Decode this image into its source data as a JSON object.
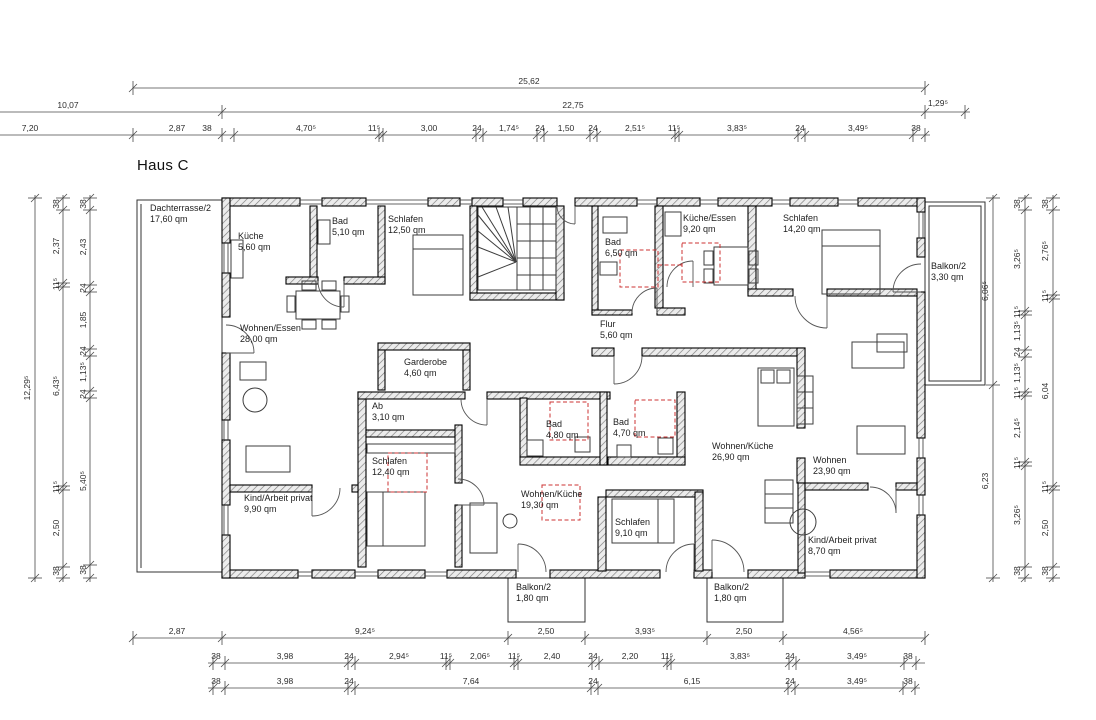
{
  "title": "Haus C",
  "colors": {
    "marker_red": "#cc3333",
    "wall_hatch": "#7a7a7a",
    "line": "#000000"
  },
  "drawing": {
    "labels": [
      {
        "t": "25,62",
        "x": 529,
        "y": 86,
        "c": "dim"
      },
      {
        "t": "10,07",
        "x": 68,
        "y": 110,
        "c": "dim"
      },
      {
        "t": "22,75",
        "x": 573,
        "y": 110,
        "c": "dim"
      },
      {
        "t": "1,29⁵",
        "x": 938,
        "y": 108,
        "c": "dim"
      },
      {
        "t": "7,20",
        "x": 30,
        "y": 133,
        "c": "dim"
      },
      {
        "t": "2,87",
        "x": 177,
        "y": 133,
        "c": "dim"
      },
      {
        "t": "38",
        "x": 207,
        "y": 133,
        "c": "dim"
      },
      {
        "t": "4,70⁵",
        "x": 306,
        "y": 133,
        "c": "dim"
      },
      {
        "t": "11⁵",
        "x": 374,
        "y": 133,
        "c": "dim"
      },
      {
        "t": "3,00",
        "x": 429,
        "y": 133,
        "c": "dim"
      },
      {
        "t": "24",
        "x": 477,
        "y": 133,
        "c": "dim"
      },
      {
        "t": "1,74⁵",
        "x": 509,
        "y": 133,
        "c": "dim"
      },
      {
        "t": "24",
        "x": 540,
        "y": 133,
        "c": "dim"
      },
      {
        "t": "1,50",
        "x": 566,
        "y": 133,
        "c": "dim"
      },
      {
        "t": "24",
        "x": 593,
        "y": 133,
        "c": "dim"
      },
      {
        "t": "2,51⁵",
        "x": 635,
        "y": 133,
        "c": "dim"
      },
      {
        "t": "11⁵",
        "x": 674,
        "y": 133,
        "c": "dim"
      },
      {
        "t": "3,83⁵",
        "x": 737,
        "y": 133,
        "c": "dim"
      },
      {
        "t": "24",
        "x": 800,
        "y": 133,
        "c": "dim"
      },
      {
        "t": "3,49⁵",
        "x": 858,
        "y": 133,
        "c": "dim"
      },
      {
        "t": "38",
        "x": 916,
        "y": 133,
        "c": "dim"
      },
      {
        "t": "2,87",
        "x": 177,
        "y": 636,
        "c": "dim"
      },
      {
        "t": "9,24⁵",
        "x": 365,
        "y": 636,
        "c": "dim"
      },
      {
        "t": "2,50",
        "x": 546,
        "y": 636,
        "c": "dim"
      },
      {
        "t": "3,93⁵",
        "x": 645,
        "y": 636,
        "c": "dim"
      },
      {
        "t": "2,50",
        "x": 744,
        "y": 636,
        "c": "dim"
      },
      {
        "t": "4,56⁵",
        "x": 853,
        "y": 636,
        "c": "dim"
      },
      {
        "t": "38",
        "x": 216,
        "y": 661,
        "c": "dim"
      },
      {
        "t": "3,98",
        "x": 285,
        "y": 661,
        "c": "dim"
      },
      {
        "t": "24",
        "x": 349,
        "y": 661,
        "c": "dim"
      },
      {
        "t": "2,94⁵",
        "x": 399,
        "y": 661,
        "c": "dim"
      },
      {
        "t": "11⁵",
        "x": 446,
        "y": 661,
        "c": "dim"
      },
      {
        "t": "2,06⁵",
        "x": 480,
        "y": 661,
        "c": "dim"
      },
      {
        "t": "11⁵",
        "x": 514,
        "y": 661,
        "c": "dim"
      },
      {
        "t": "2,40",
        "x": 552,
        "y": 661,
        "c": "dim"
      },
      {
        "t": "24",
        "x": 593,
        "y": 661,
        "c": "dim"
      },
      {
        "t": "2,20",
        "x": 630,
        "y": 661,
        "c": "dim"
      },
      {
        "t": "11⁵",
        "x": 667,
        "y": 661,
        "c": "dim"
      },
      {
        "t": "3,83⁵",
        "x": 740,
        "y": 661,
        "c": "dim"
      },
      {
        "t": "24",
        "x": 790,
        "y": 661,
        "c": "dim"
      },
      {
        "t": "3,49⁵",
        "x": 857,
        "y": 661,
        "c": "dim"
      },
      {
        "t": "38",
        "x": 908,
        "y": 661,
        "c": "dim"
      },
      {
        "t": "38",
        "x": 216,
        "y": 686,
        "c": "dim"
      },
      {
        "t": "3,98",
        "x": 285,
        "y": 686,
        "c": "dim"
      },
      {
        "t": "24",
        "x": 349,
        "y": 686,
        "c": "dim"
      },
      {
        "t": "7,64",
        "x": 471,
        "y": 686,
        "c": "dim"
      },
      {
        "t": "24",
        "x": 593,
        "y": 686,
        "c": "dim"
      },
      {
        "t": "6,15",
        "x": 692,
        "y": 686,
        "c": "dim"
      },
      {
        "t": "24",
        "x": 790,
        "y": 686,
        "c": "dim"
      },
      {
        "t": "3,49⁵",
        "x": 857,
        "y": 686,
        "c": "dim"
      },
      {
        "t": "38",
        "x": 908,
        "y": 686,
        "c": "dim"
      },
      {
        "t": "12,29⁵",
        "x": 27,
        "y": 388,
        "c": "dim rot"
      },
      {
        "t": "38",
        "x": 56,
        "y": 204,
        "c": "dim rot"
      },
      {
        "t": "2,37",
        "x": 56,
        "y": 246,
        "c": "dim rot"
      },
      {
        "t": "11⁵",
        "x": 56,
        "y": 284,
        "c": "dim rot"
      },
      {
        "t": "6,43⁵",
        "x": 56,
        "y": 386,
        "c": "dim rot"
      },
      {
        "t": "11⁵",
        "x": 56,
        "y": 487,
        "c": "dim rot"
      },
      {
        "t": "2,50",
        "x": 56,
        "y": 528,
        "c": "dim rot"
      },
      {
        "t": "38",
        "x": 56,
        "y": 571,
        "c": "dim rot"
      },
      {
        "t": "38",
        "x": 83,
        "y": 204,
        "c": "dim rot"
      },
      {
        "t": "2,43",
        "x": 83,
        "y": 247,
        "c": "dim rot"
      },
      {
        "t": "24",
        "x": 83,
        "y": 288,
        "c": "dim rot"
      },
      {
        "t": "1,85",
        "x": 83,
        "y": 320,
        "c": "dim rot"
      },
      {
        "t": "24",
        "x": 83,
        "y": 351,
        "c": "dim rot"
      },
      {
        "t": "1,13⁵",
        "x": 83,
        "y": 372,
        "c": "dim rot"
      },
      {
        "t": "24",
        "x": 83,
        "y": 394,
        "c": "dim rot"
      },
      {
        "t": "5,40⁵",
        "x": 83,
        "y": 481,
        "c": "dim rot"
      },
      {
        "t": "38",
        "x": 83,
        "y": 570,
        "c": "dim rot"
      },
      {
        "t": "6,06⁵",
        "x": 985,
        "y": 291,
        "c": "dim rot"
      },
      {
        "t": "6,23",
        "x": 985,
        "y": 481,
        "c": "dim rot"
      },
      {
        "t": "38",
        "x": 1017,
        "y": 204,
        "c": "dim rot"
      },
      {
        "t": "3,26⁵",
        "x": 1017,
        "y": 259,
        "c": "dim rot"
      },
      {
        "t": "11⁵",
        "x": 1017,
        "y": 312,
        "c": "dim rot"
      },
      {
        "t": "1,13⁵",
        "x": 1017,
        "y": 331,
        "c": "dim rot"
      },
      {
        "t": "24",
        "x": 1017,
        "y": 352,
        "c": "dim rot"
      },
      {
        "t": "1,13⁵",
        "x": 1017,
        "y": 373,
        "c": "dim rot"
      },
      {
        "t": "11⁵",
        "x": 1017,
        "y": 393,
        "c": "dim rot"
      },
      {
        "t": "2,14⁵",
        "x": 1017,
        "y": 428,
        "c": "dim rot"
      },
      {
        "t": "11⁵",
        "x": 1017,
        "y": 463,
        "c": "dim rot"
      },
      {
        "t": "3,26⁵",
        "x": 1017,
        "y": 515,
        "c": "dim rot"
      },
      {
        "t": "38",
        "x": 1017,
        "y": 571,
        "c": "dim rot"
      },
      {
        "t": "38",
        "x": 1045,
        "y": 204,
        "c": "dim rot"
      },
      {
        "t": "2,76⁵",
        "x": 1045,
        "y": 251,
        "c": "dim rot"
      },
      {
        "t": "11⁵",
        "x": 1045,
        "y": 296,
        "c": "dim rot"
      },
      {
        "t": "6,04",
        "x": 1045,
        "y": 391,
        "c": "dim rot"
      },
      {
        "t": "11⁵",
        "x": 1045,
        "y": 487,
        "c": "dim rot"
      },
      {
        "t": "2,50",
        "x": 1045,
        "y": 528,
        "c": "dim rot"
      },
      {
        "t": "38",
        "x": 1045,
        "y": 571,
        "c": "dim rot"
      },
      {
        "n": "room-dachterrasse",
        "l1": "Dachterrasse/2",
        "l2": "17,60 qm",
        "x": 150,
        "y": 203,
        "c": "room"
      },
      {
        "n": "room-kueche",
        "l1": "Küche",
        "l2": "5,60 qm",
        "x": 238,
        "y": 231,
        "c": "room"
      },
      {
        "n": "room-bad-510",
        "l1": "Bad",
        "l2": "5,10 qm",
        "x": 332,
        "y": 216,
        "c": "room"
      },
      {
        "n": "room-schlafen-1250",
        "l1": "Schlafen",
        "l2": "12,50 qm",
        "x": 388,
        "y": 214,
        "c": "room"
      },
      {
        "n": "room-bad-650",
        "l1": "Bad",
        "l2": "6,50 qm",
        "x": 605,
        "y": 237,
        "c": "room"
      },
      {
        "n": "room-kueche-essen",
        "l1": "Küche/Essen",
        "l2": "9,20 qm",
        "x": 683,
        "y": 213,
        "c": "room"
      },
      {
        "n": "room-schlafen-1420",
        "l1": "Schlafen",
        "l2": "14,20 qm",
        "x": 783,
        "y": 213,
        "c": "room"
      },
      {
        "n": "room-balkon-330",
        "l1": "Balkon/2",
        "l2": "3,30 qm",
        "x": 931,
        "y": 261,
        "c": "room"
      },
      {
        "n": "room-wohnen-essen",
        "l1": "Wohnen/Essen",
        "l2": "28,00 qm",
        "x": 240,
        "y": 323,
        "c": "room"
      },
      {
        "n": "room-flur",
        "l1": "Flur",
        "l2": "5,60 qm",
        "x": 600,
        "y": 319,
        "c": "room"
      },
      {
        "n": "room-garderobe",
        "l1": "Garderobe",
        "l2": "4,60 qm",
        "x": 404,
        "y": 357,
        "c": "room"
      },
      {
        "n": "room-ab",
        "l1": "Ab",
        "l2": "3,10 qm",
        "x": 372,
        "y": 401,
        "c": "room"
      },
      {
        "n": "room-schlafen-1240",
        "l1": "Schlafen",
        "l2": "12,40 qm",
        "x": 372,
        "y": 456,
        "c": "room"
      },
      {
        "n": "room-bad-480",
        "l1": "Bad",
        "l2": "4,80 qm",
        "x": 546,
        "y": 419,
        "c": "room"
      },
      {
        "n": "room-bad-470",
        "l1": "Bad",
        "l2": "4,70 qm",
        "x": 613,
        "y": 417,
        "c": "room"
      },
      {
        "n": "room-wohnen-kueche-2690",
        "l1": "Wohnen/Küche",
        "l2": "26,90 qm",
        "x": 712,
        "y": 441,
        "c": "room"
      },
      {
        "n": "room-wohnen-2390",
        "l1": "Wohnen",
        "l2": "23,90 qm",
        "x": 813,
        "y": 455,
        "c": "room"
      },
      {
        "n": "room-wohnen-kueche-1930",
        "l1": "Wohnen/Küche",
        "l2": "19,30 qm",
        "x": 521,
        "y": 489,
        "c": "room"
      },
      {
        "n": "room-schlafen-910",
        "l1": "Schlafen",
        "l2": "9,10 qm",
        "x": 615,
        "y": 517,
        "c": "room"
      },
      {
        "n": "room-kind-arbeit-990",
        "l1": "Kind/Arbeit privat",
        "l2": "9,90 qm",
        "x": 244,
        "y": 493,
        "c": "room"
      },
      {
        "n": "room-kind-arbeit-870",
        "l1": "Kind/Arbeit privat",
        "l2": "8,70 qm",
        "x": 808,
        "y": 535,
        "c": "room"
      },
      {
        "n": "room-balkon-left",
        "l1": "Balkon/2",
        "l2": "1,80 qm",
        "x": 516,
        "y": 582,
        "c": "room"
      },
      {
        "n": "room-balkon-right",
        "l1": "Balkon/2",
        "l2": "1,80 qm",
        "x": 714,
        "y": 582,
        "c": "room"
      }
    ],
    "dimension_lines": [
      {
        "y": 88,
        "x1": 133,
        "x2": 925,
        "ticks": [
          133,
          925
        ]
      },
      {
        "y": 112,
        "x1": 0,
        "x2": 970,
        "ticks": [
          222,
          925,
          965
        ]
      },
      {
        "y": 135,
        "x1": 0,
        "x2": 930,
        "ticks": [
          133,
          222,
          234,
          379,
          383,
          476,
          483,
          537,
          544,
          590,
          597,
          675,
          679,
          798,
          805,
          913,
          925
        ]
      },
      {
        "y": 638,
        "x1": 133,
        "x2": 925,
        "ticks": [
          133,
          222,
          508,
          585,
          707,
          783,
          925
        ]
      },
      {
        "y": 663,
        "x1": 208,
        "x2": 925,
        "ticks": [
          213,
          225,
          348,
          355,
          446,
          450,
          514,
          518,
          592,
          599,
          667,
          671,
          789,
          796,
          904,
          916
        ]
      },
      {
        "y": 688,
        "x1": 208,
        "x2": 920,
        "ticks": [
          213,
          225,
          348,
          355,
          591,
          598,
          788,
          795,
          903,
          915
        ]
      },
      {
        "x": 35,
        "y1": 195,
        "y2": 582,
        "ticks": [
          198,
          578
        ]
      },
      {
        "x": 63,
        "y1": 195,
        "y2": 582,
        "ticks": [
          198,
          210,
          283,
          287,
          486,
          490,
          567,
          578
        ]
      },
      {
        "x": 90,
        "y1": 195,
        "y2": 582,
        "ticks": [
          198,
          210,
          285,
          292,
          349,
          356,
          391,
          398,
          565,
          578
        ]
      },
      {
        "x": 993,
        "y1": 195,
        "y2": 582,
        "ticks": [
          198,
          385,
          578
        ]
      },
      {
        "x": 1025,
        "y1": 195,
        "y2": 582,
        "ticks": [
          198,
          210,
          311,
          315,
          350,
          357,
          392,
          396,
          462,
          466,
          567,
          578
        ]
      },
      {
        "x": 1053,
        "y1": 195,
        "y2": 582,
        "ticks": [
          198,
          210,
          295,
          299,
          486,
          490,
          567,
          578
        ]
      }
    ]
  }
}
